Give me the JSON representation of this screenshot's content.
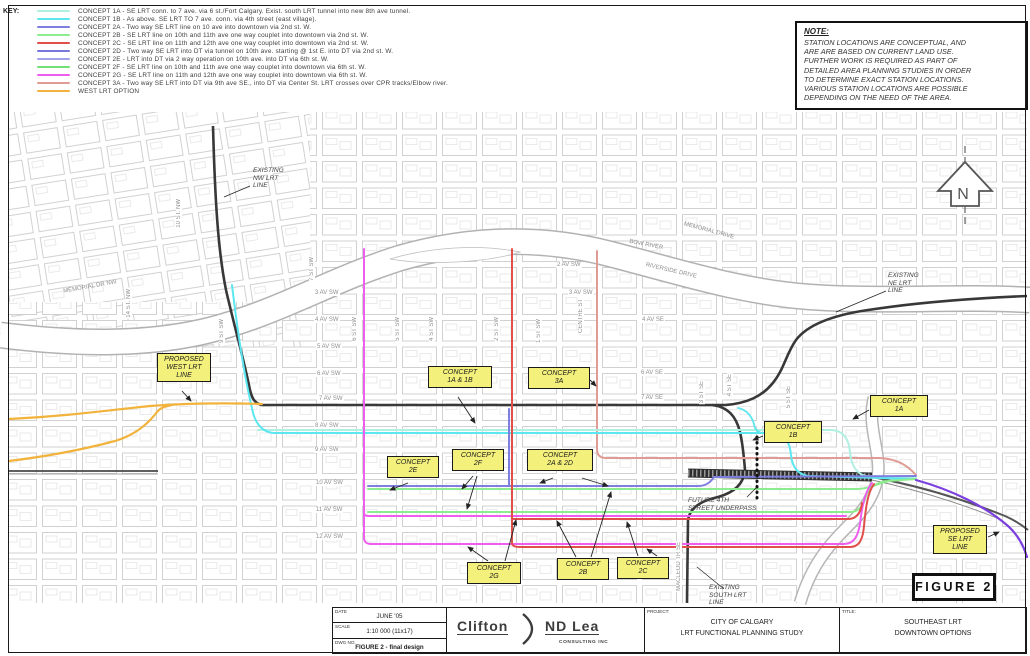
{
  "key": {
    "title": "KEY:",
    "items": [
      {
        "id": "1A",
        "color": "#aff0e2",
        "label": "CONCEPT 1A - SE LRT conn. to 7 ave. via 6 st./Fort Calgary. Exist. south LRT tunnel into new 8th ave tunnel."
      },
      {
        "id": "1B",
        "color": "#5ce6f0",
        "label": "CONCEPT 1B - As above. SE LRT TO 7 ave. conn. via 4th street (east village)."
      },
      {
        "id": "2A",
        "color": "#7f7fe0",
        "label": "CONCEPT 2A - Two way SE LRT line on 10 ave into downtown via 2nd st. W."
      },
      {
        "id": "2B",
        "color": "#8dec8d",
        "label": "CONCEPT 2B - SE LRT line on 10th and 11th ave one way couplet into downtown via 2nd st. W."
      },
      {
        "id": "2C",
        "color": "#e14f4b",
        "label": "CONCEPT 2C - SE LRT line on 11th and 12th ave one way couplet into downtown via 2nd st. W."
      },
      {
        "id": "2D",
        "color": "#7878dc",
        "label": "CONCEPT 2D - Two way SE LRT into DT via tunnel on 10th ave. starting @ 1st E. into DT via 2nd st. W."
      },
      {
        "id": "2E",
        "color": "#a2a2ec",
        "label": "CONCEPT 2E - LRT into DT via 2 way operation on 10th ave. into DT via 6th st. W."
      },
      {
        "id": "2F",
        "color": "#72e072",
        "label": "CONCEPT 2F - SE LRT line on 10th and 11th ave one way couplet into downtown via 6th st. W."
      },
      {
        "id": "2G",
        "color": "#ee5dee",
        "label": "CONCEPT 2G - SE LRT line on 11th and 12th ave one way couplet into downtown via 6th st. W."
      },
      {
        "id": "3A",
        "color": "#df9b94",
        "label": "CONCEPT 3A - Two way SE LRT into DT via 9th ave SE., into DT via Center St.  LRT crosses over CPR tracks/Elbow river."
      },
      {
        "id": "WEST",
        "color": "#f2b33d",
        "label": "WEST LRT OPTION"
      }
    ]
  },
  "note": {
    "title": "NOTE:",
    "lines": [
      "STATION LOCATIONS ARE CONCEPTUAL, AND",
      "ARE ARE BASED ON CURRENT LAND USE.",
      "FURTHER WORK IS REQUIRED AS PART OF",
      "DETAILED AREA PLANNING STUDIES IN ORDER",
      "TO DETERMINE EXACT STATION LOCATIONS.",
      "VARIOUS STATION LOCATIONS ARE POSSIBLE",
      "DEPENDING ON THE NEED OF THE AREA."
    ]
  },
  "north_label": "N",
  "figure_label": "FIGURE 2",
  "map": {
    "colors": {
      "existing": "#383838",
      "rail": "#4a4a4a",
      "corridor": "#2e2e2e",
      "SE": "#7b3fe0",
      "dotted": "#111111"
    },
    "concept_labels": [
      {
        "id": "proposed-west-lrt",
        "x": 157,
        "y": 353,
        "w": 54,
        "lines": [
          "PROPOSED",
          "WEST LRT",
          "LINE"
        ]
      },
      {
        "id": "concept-1a-1b",
        "x": 428,
        "y": 366,
        "w": 64,
        "lines": [
          "CONCEPT",
          "1A & 1B"
        ]
      },
      {
        "id": "concept-3a",
        "x": 528,
        "y": 367,
        "w": 62,
        "lines": [
          "CONCEPT",
          "3A"
        ]
      },
      {
        "id": "concept-1b",
        "x": 764,
        "y": 421,
        "w": 58,
        "lines": [
          "CONCEPT",
          "1B"
        ]
      },
      {
        "id": "concept-1a",
        "x": 870,
        "y": 395,
        "w": 58,
        "lines": [
          "CONCEPT",
          "1A"
        ]
      },
      {
        "id": "concept-2e",
        "x": 387,
        "y": 456,
        "w": 52,
        "lines": [
          "CONCEPT",
          "2E"
        ]
      },
      {
        "id": "concept-2f",
        "x": 452,
        "y": 449,
        "w": 52,
        "lines": [
          "CONCEPT",
          "2F"
        ]
      },
      {
        "id": "concept-2a-2d",
        "x": 527,
        "y": 449,
        "w": 66,
        "lines": [
          "CONCEPT",
          "2A & 2D"
        ]
      },
      {
        "id": "concept-2g",
        "x": 467,
        "y": 562,
        "w": 54,
        "lines": [
          "CONCEPT",
          "2G"
        ]
      },
      {
        "id": "concept-2b",
        "x": 557,
        "y": 558,
        "w": 52,
        "lines": [
          "CONCEPT",
          "2B"
        ]
      },
      {
        "id": "concept-2c",
        "x": 617,
        "y": 557,
        "w": 52,
        "lines": [
          "CONCEPT",
          "2C"
        ]
      },
      {
        "id": "proposed-se-lrt",
        "x": 933,
        "y": 525,
        "w": 54,
        "lines": [
          "PROPOSED",
          "SE LRT",
          "LINE"
        ]
      }
    ],
    "text_labels": [
      {
        "id": "existing-nw-lrt",
        "x": 253,
        "y": 167,
        "lines": [
          "EXISTING",
          "NW LRT",
          "LINE"
        ]
      },
      {
        "id": "existing-ne-lrt",
        "x": 888,
        "y": 272,
        "lines": [
          "EXISTING",
          "NE LRT",
          "LINE"
        ]
      },
      {
        "id": "future-4th-street-underpass",
        "x": 688,
        "y": 497,
        "lines": [
          "FUTURE 4TH",
          "STREET UNDERPASS"
        ]
      },
      {
        "id": "existing-south-lrt",
        "x": 709,
        "y": 584,
        "lines": [
          "EXISTING",
          "SOUTH LRT",
          "LINE"
        ]
      }
    ],
    "street_labels": [
      {
        "t": "3 AV SW",
        "x": 314,
        "y": 290,
        "dir": "h"
      },
      {
        "t": "4 AV SW",
        "x": 314,
        "y": 317,
        "dir": "h"
      },
      {
        "t": "5 AV SW",
        "x": 316,
        "y": 344,
        "dir": "h"
      },
      {
        "t": "6 AV SW",
        "x": 316,
        "y": 371,
        "dir": "h"
      },
      {
        "t": "7 AV SW",
        "x": 318,
        "y": 396,
        "dir": "h"
      },
      {
        "t": "8 AV SW",
        "x": 314,
        "y": 423,
        "dir": "h"
      },
      {
        "t": "9 AV SW",
        "x": 314,
        "y": 447,
        "dir": "h"
      },
      {
        "t": "10 AV SW",
        "x": 315,
        "y": 480,
        "dir": "h"
      },
      {
        "t": "11 AV SW",
        "x": 315,
        "y": 507,
        "dir": "h"
      },
      {
        "t": "12 AV SW",
        "x": 315,
        "y": 534,
        "dir": "h"
      },
      {
        "t": "2 AV SW",
        "x": 556,
        "y": 262,
        "dir": "h"
      },
      {
        "t": "3 AV SW",
        "x": 568,
        "y": 290,
        "dir": "h"
      },
      {
        "t": "4 AV SE",
        "x": 641,
        "y": 317,
        "dir": "h"
      },
      {
        "t": "6 AV SE",
        "x": 640,
        "y": 370,
        "dir": "h"
      },
      {
        "t": "7 AV SE",
        "x": 640,
        "y": 395,
        "dir": "h"
      },
      {
        "t": "14 ST. NW",
        "x": 126,
        "y": 288,
        "dir": "v"
      },
      {
        "t": "10 ST. NW",
        "x": 176,
        "y": 198,
        "dir": "v"
      },
      {
        "t": "9 ST SW",
        "x": 219,
        "y": 318,
        "dir": "v"
      },
      {
        "t": "7 ST SW",
        "x": 309,
        "y": 256,
        "dir": "v"
      },
      {
        "t": "6 ST SW",
        "x": 352,
        "y": 316,
        "dir": "v"
      },
      {
        "t": "5 ST SW",
        "x": 395,
        "y": 316,
        "dir": "v"
      },
      {
        "t": "4 ST SW",
        "x": 429,
        "y": 316,
        "dir": "v"
      },
      {
        "t": "2 ST SW",
        "x": 494,
        "y": 316,
        "dir": "v"
      },
      {
        "t": "1 ST SW",
        "x": 536,
        "y": 318,
        "dir": "v"
      },
      {
        "t": "CENTRE ST",
        "x": 578,
        "y": 298,
        "dir": "v"
      },
      {
        "t": "3 ST SE",
        "x": 699,
        "y": 380,
        "dir": "v"
      },
      {
        "t": "4 ST SE",
        "x": 727,
        "y": 373,
        "dir": "v"
      },
      {
        "t": "5 ST SE",
        "x": 786,
        "y": 385,
        "dir": "v"
      },
      {
        "t": "MACLEOD TR SE",
        "x": 676,
        "y": 541,
        "dir": "v"
      },
      {
        "t": "MEMORIAL DR NW",
        "x": 62,
        "y": 284,
        "dir": "h",
        "rot": -10
      },
      {
        "t": "MEMORIAL DRIVE",
        "x": 682,
        "y": 228,
        "dir": "h",
        "rot": 15
      },
      {
        "t": "BOW RIVER",
        "x": 628,
        "y": 242,
        "dir": "h",
        "rot": 11
      },
      {
        "t": "RIVERSIDE DRIVE",
        "x": 644,
        "y": 268,
        "dir": "h",
        "rot": 13
      }
    ]
  },
  "titleblock": {
    "date_label": "DATE",
    "date": "JUNE '05",
    "scale_label": "SCALE",
    "scale": "1:10 000 (11x17)",
    "dwg_label": "DWG NO.",
    "dwg": "FIGURE 2 - final design",
    "logo_left": "Clifton",
    "logo_right": "ND Lea",
    "logo_sub": "CONSULTING INC",
    "project_label": "PROJECT:",
    "project_lines": [
      "CITY OF CALGARY",
      "LRT FUNCTIONAL PLANNING STUDY"
    ],
    "title_label": "TITLE:",
    "title_lines": [
      "SOUTHEAST LRT",
      "DOWNTOWN OPTIONS"
    ]
  }
}
